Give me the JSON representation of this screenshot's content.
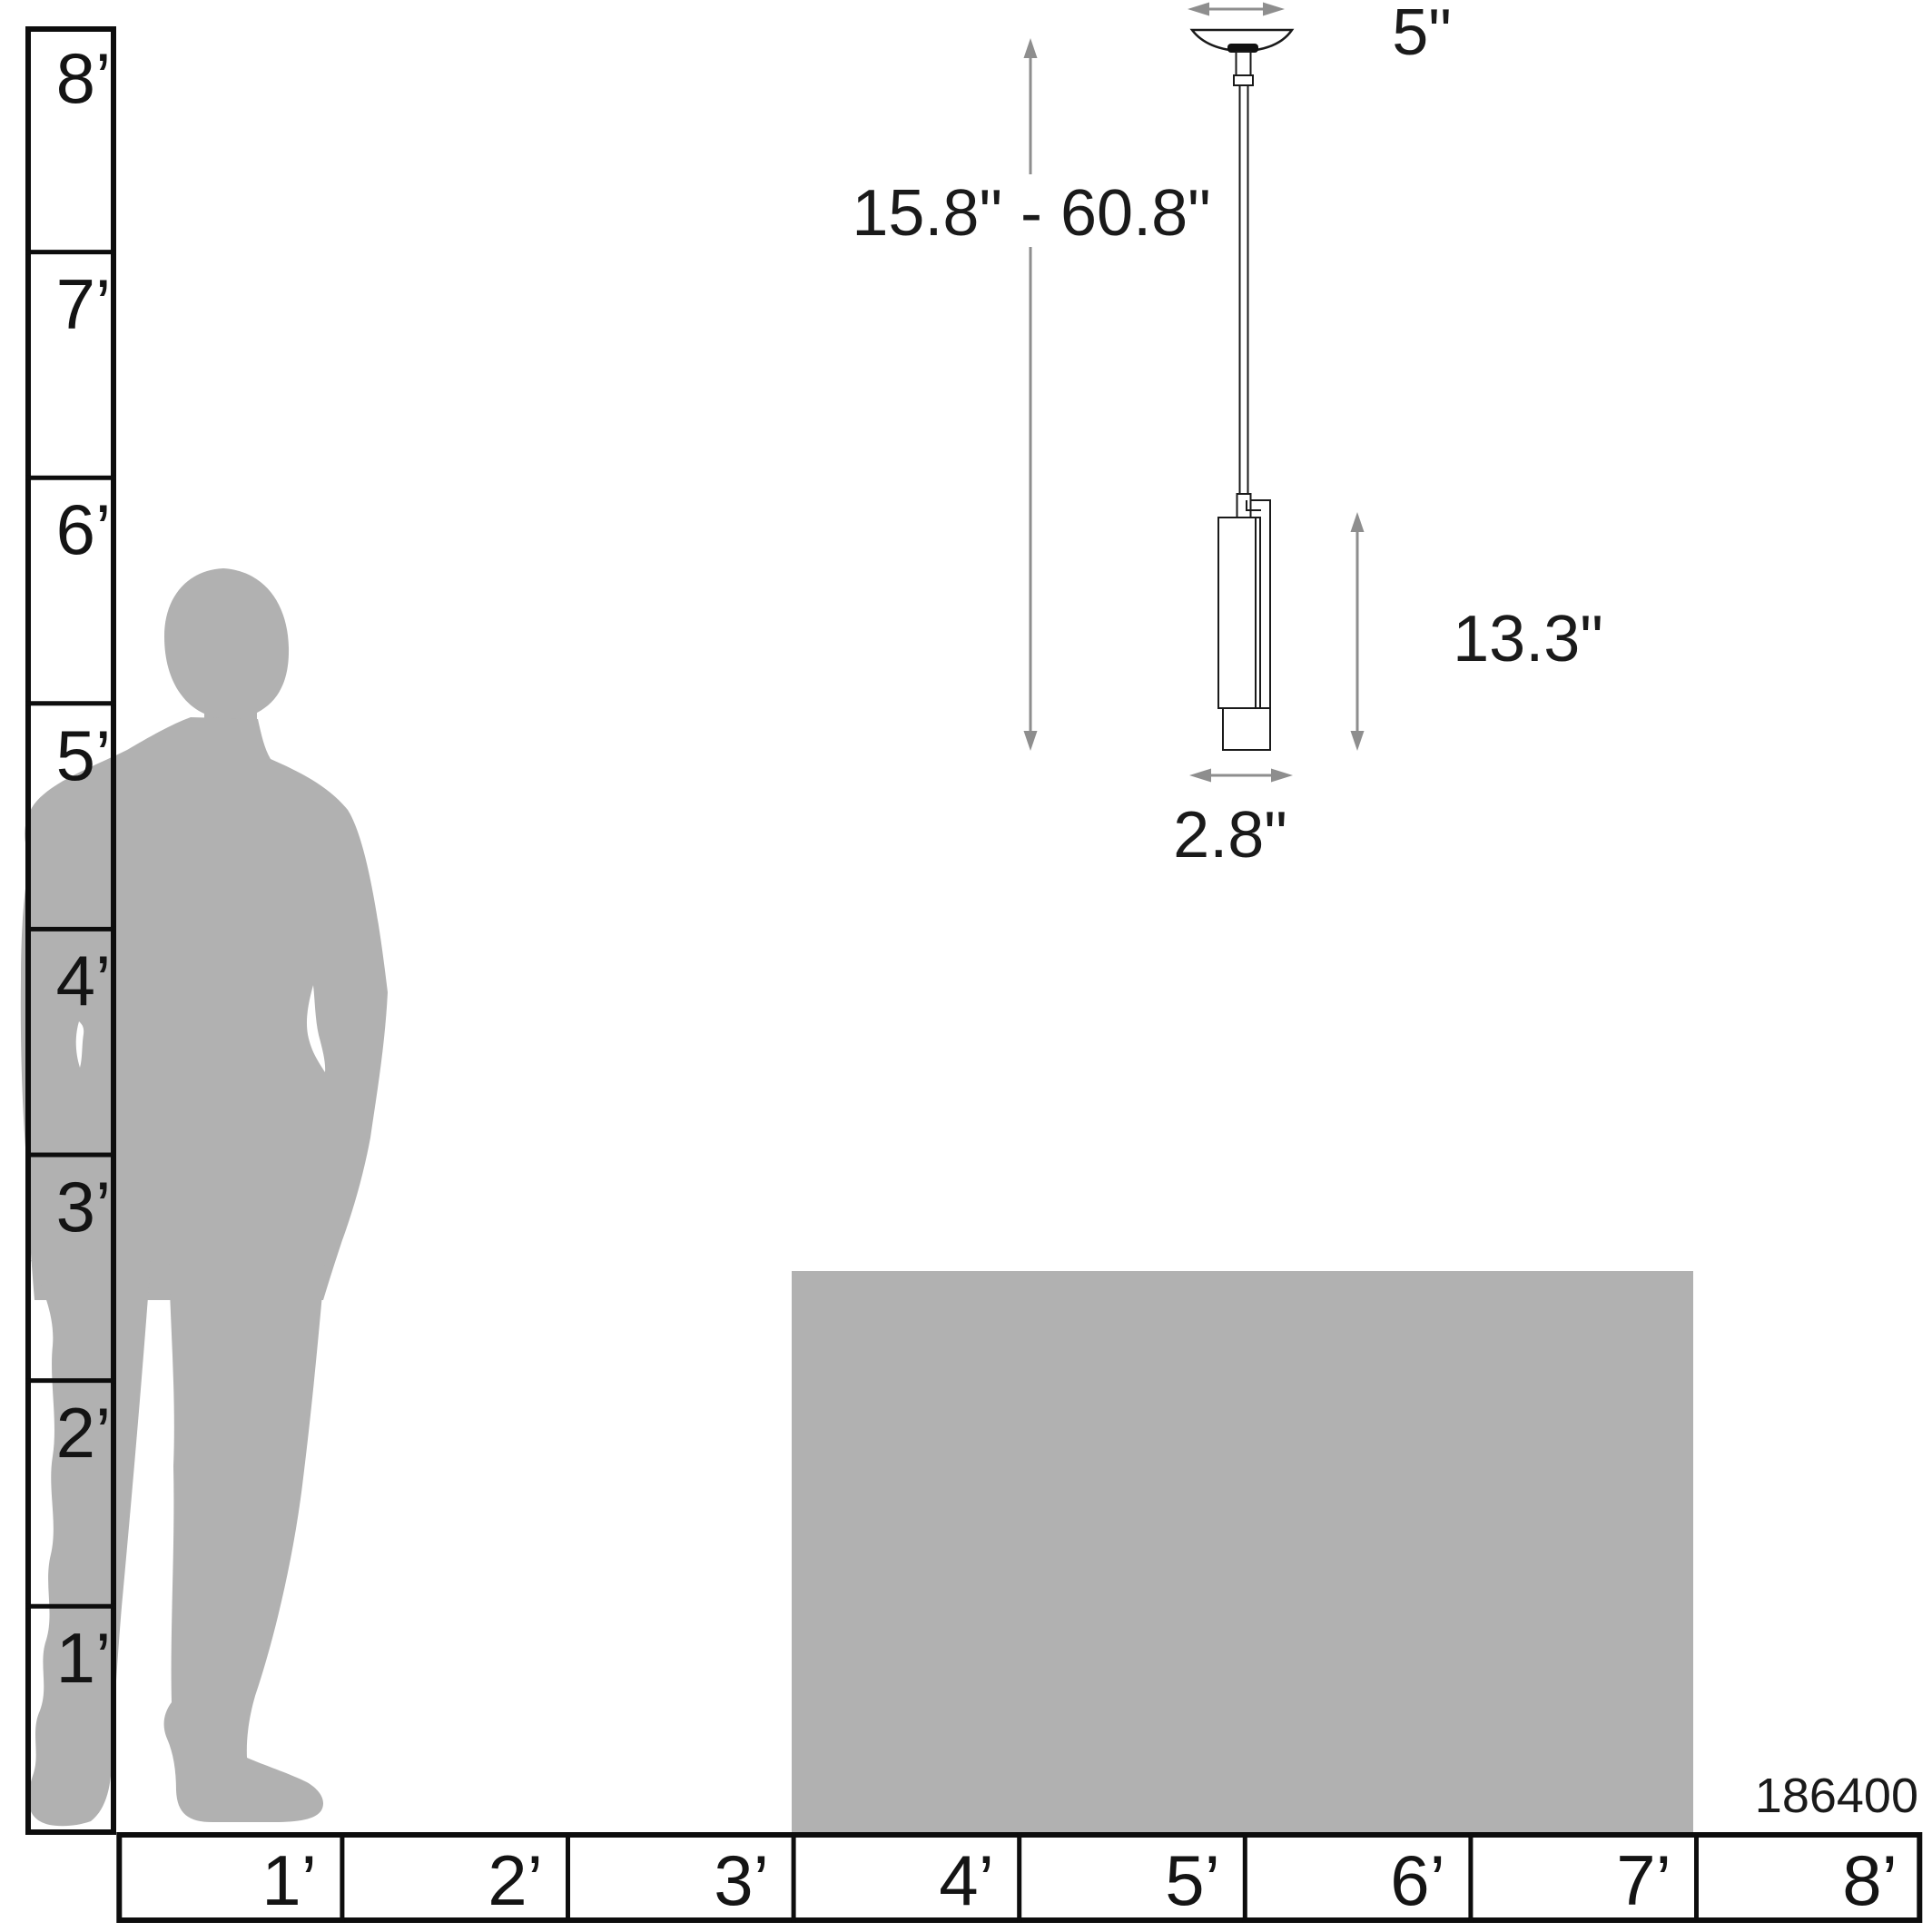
{
  "diagram": {
    "product_code": "186400",
    "pendant": {
      "canopy_width": "5\"",
      "height_range": "15.8\" - 60.8\"",
      "body_height": "13.3\"",
      "body_width": "2.8\""
    },
    "rulers": {
      "vertical": [
        "8’",
        "7’",
        "6’",
        "5’",
        "4’",
        "3’",
        "2’",
        "1’"
      ],
      "horizontal": [
        "1’",
        "2’",
        "3’",
        "4’",
        "5’",
        "6’",
        "7’",
        "8’"
      ]
    },
    "colors": {
      "figure_gray": "#b1b1b1",
      "arrow_gray": "#8e8e8e",
      "line_color": "#111111"
    }
  }
}
